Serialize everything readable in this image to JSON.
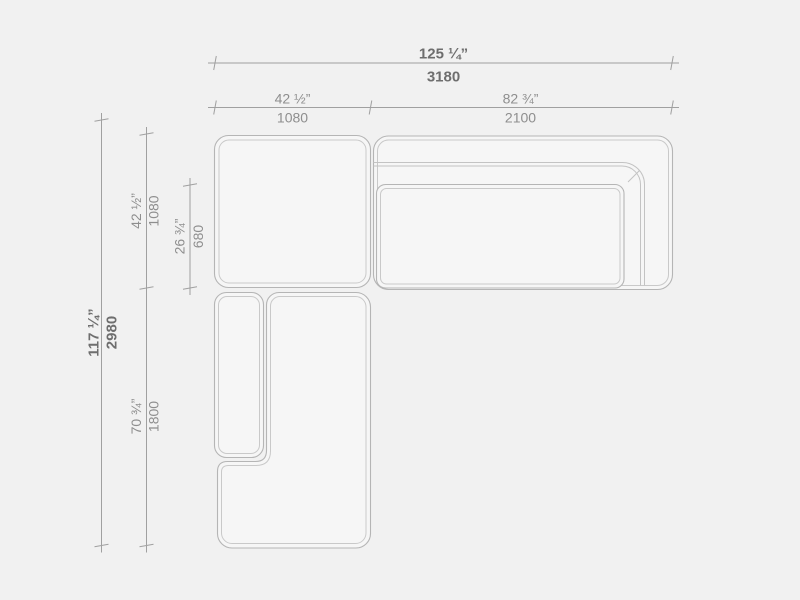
{
  "diagram": {
    "type": "sectional-sofa-top-view-dimension-drawing",
    "dims": {
      "overall_width": {
        "inches": "125 ¼”",
        "mm": "3180"
      },
      "left_width": {
        "inches": "42 ½”",
        "mm": "1080"
      },
      "right_width": {
        "inches": "82 ¾”",
        "mm": "2100"
      },
      "overall_depth": {
        "inches": "117 ¼”",
        "mm": "2980"
      },
      "top_depth": {
        "inches": "42 ½”",
        "mm": "1080"
      },
      "seat_depth": {
        "inches": "26 ¾”",
        "mm": "680"
      },
      "left_length": {
        "inches": "70 ¾”",
        "mm": "1800"
      }
    },
    "colors": {
      "background": "#f1f1f1",
      "piece_fill": "#f6f6f6",
      "outline": "#b5b5b5",
      "outline_inner": "#c9c9c9",
      "dim_line": "#a0a0a0",
      "label_regular": "#8e8e8e",
      "label_bold": "#6e6e6e"
    }
  }
}
